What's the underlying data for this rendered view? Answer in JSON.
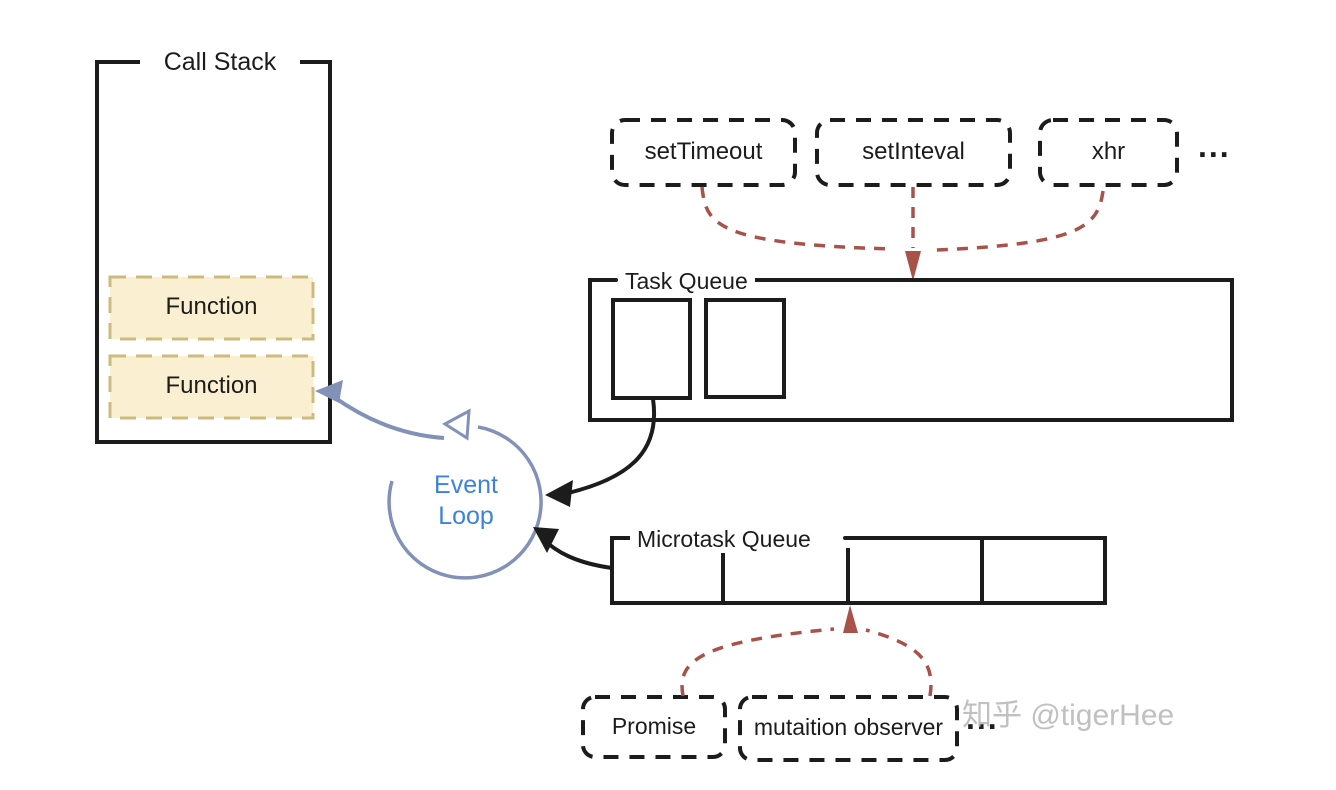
{
  "call_stack": {
    "title": "Call Stack",
    "frames": [
      "Function",
      "Function"
    ]
  },
  "event_loop": {
    "line1": "Event",
    "line2": "Loop"
  },
  "macrotask_sources": {
    "items": [
      "setTimeout",
      "setInteval",
      "xhr"
    ],
    "ellipsis": "..."
  },
  "task_queue": {
    "title": "Task Queue"
  },
  "microtask_queue": {
    "title": "Microtask Queue"
  },
  "microtask_sources": {
    "items": [
      "Promise",
      "mutaition observer"
    ],
    "ellipsis": "..."
  },
  "watermark": "知乎 @tigerHee",
  "colors": {
    "ink_black": "#1c1c1c",
    "arrow_red": "#a8524a",
    "loop_blue": "#8191b8",
    "event_text_blue": "#3d82dc",
    "frame_fill": "#faf0d1",
    "frame_border": "#cdbb7e",
    "watermark_gray": "#b9b9b9"
  }
}
